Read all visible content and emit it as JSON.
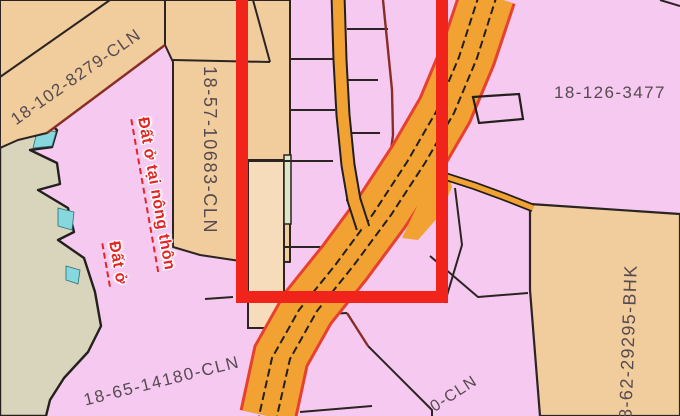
{
  "map": {
    "labels": {
      "parcel_top_left": "18-102-8279-CLN",
      "parcel_center_vertical": "18-57-10683-CLN",
      "parcel_right": "18-126-3477",
      "parcel_bottom_right_vertical": "18-62-29295-BHK",
      "parcel_bottom_left": "18-65-14180-CLN",
      "parcel_partial_bottom": "0-CLN",
      "landuse_note_line1": "Đất ở tại nông thôn",
      "landuse_note_line2": "Đất ở"
    },
    "colors": {
      "parcel_pink": "#f6c9f0",
      "parcel_tan": "#f1cd9d",
      "parcel_peach": "#f6dcba",
      "parcel_green_sliver": "#dde6c4",
      "road_orange": "#f2a233",
      "road_edge_red": "#e8402e",
      "water_cyan": "#86d7de",
      "terrain_gray": "#d9d5bd",
      "boundary_dark": "#2b2422",
      "boundary_maroon": "#872e26",
      "highlight_rectangle_red": "#f1241c",
      "label_text": "#564a50",
      "landuse_text_red": "#e32525"
    }
  }
}
